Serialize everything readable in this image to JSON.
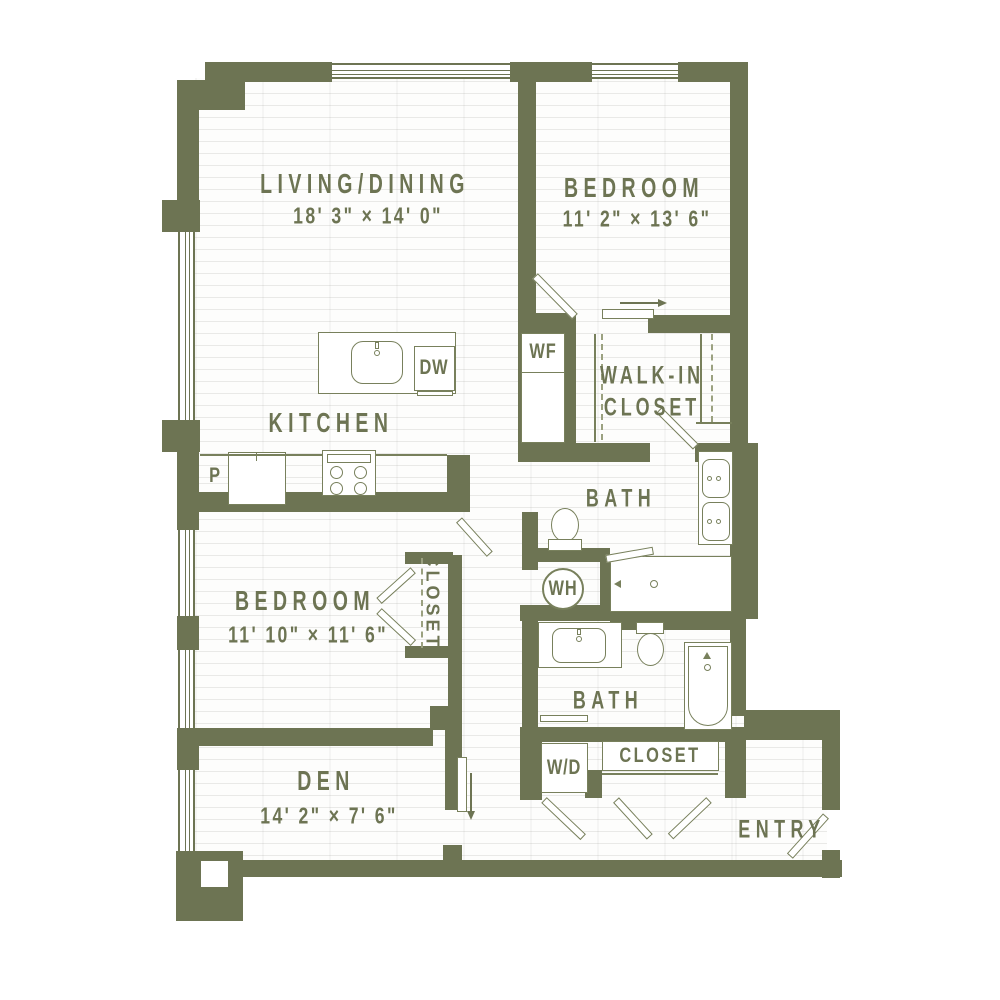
{
  "plan": {
    "rooms": {
      "living": {
        "name": "LIVING/DINING",
        "dims": "18' 3\" × 14' 0\""
      },
      "bedroom1": {
        "name": "BEDROOM",
        "dims": "11' 2\" × 13' 6\""
      },
      "walkin": {
        "name": "WALK-IN\nCLOSET"
      },
      "kitchen": {
        "name": "KITCHEN"
      },
      "bath1": {
        "name": "BATH"
      },
      "bedroom2": {
        "name": "BEDROOM",
        "dims": "11' 10\" × 11' 6\""
      },
      "closet2": {
        "name": "CLOSET"
      },
      "den": {
        "name": "DEN",
        "dims": "14' 2\" × 7' 6\""
      },
      "bath2": {
        "name": "BATH"
      },
      "entry_closet": {
        "name": "CLOSET"
      },
      "entry": {
        "name": "ENTRY"
      }
    },
    "fixtures": {
      "wine_fridge": "WF",
      "dishwasher": "DW",
      "pantry": "P",
      "water_heater": "WH",
      "washer_dryer": "W/D"
    },
    "colors": {
      "wall": "#6d7453",
      "text": "#6d7453",
      "background": "#ffffff"
    }
  }
}
